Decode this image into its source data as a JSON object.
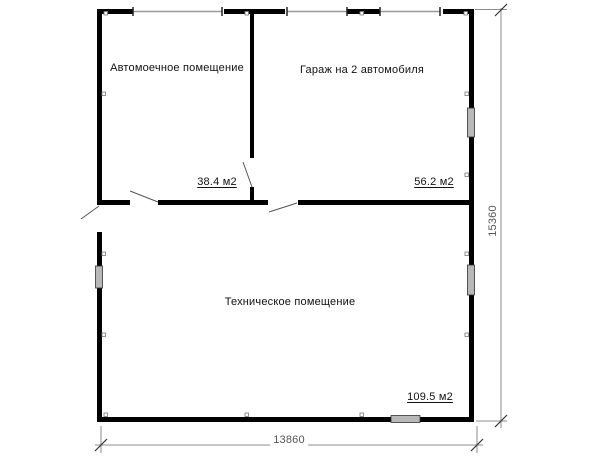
{
  "plan": {
    "rooms": [
      {
        "name": "Автомоечное помещение",
        "area": "38.4 м2"
      },
      {
        "name": "Гараж на 2 автомобиля",
        "area": "56.2 м2"
      },
      {
        "name": "Техническое помещение",
        "area": "109.5 м2"
      }
    ],
    "dimensions": {
      "width_mm": "13860",
      "height_mm": "15360"
    },
    "colors": {
      "wall": "#000000",
      "window_fill": "#b8b8b8",
      "dimension_line": "#8c8c8c",
      "dimension_text": "#555555",
      "label_text": "#111111",
      "background": "#ffffff"
    }
  }
}
